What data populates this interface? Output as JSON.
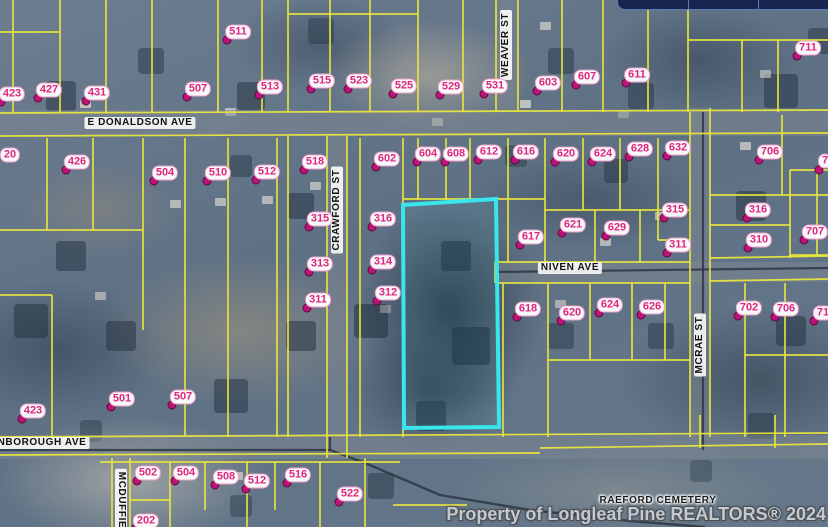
{
  "map": {
    "watermark": "Property of Longleaf Pine REALTORS® 2024",
    "colors": {
      "parcel_line": "#e9e63e",
      "highlight": "#38e6ec",
      "label_text": "#e0267f",
      "marker_dot": "#bb1377",
      "boundary_dark": "#2a3240",
      "road_fill": "rgba(128,136,146,0.5)"
    },
    "highlight_parcel_points": "403,205 496,199 499,427 404,428",
    "parcel_labels": [
      {
        "t": "423",
        "x": 12,
        "y": 94
      },
      {
        "t": "427",
        "x": 49,
        "y": 90
      },
      {
        "t": "431",
        "x": 97,
        "y": 93
      },
      {
        "t": "507",
        "x": 198,
        "y": 89
      },
      {
        "t": "511",
        "x": 238,
        "y": 32
      },
      {
        "t": "513",
        "x": 270,
        "y": 87
      },
      {
        "t": "515",
        "x": 322,
        "y": 81
      },
      {
        "t": "523",
        "x": 359,
        "y": 81
      },
      {
        "t": "525",
        "x": 404,
        "y": 86
      },
      {
        "t": "529",
        "x": 451,
        "y": 87
      },
      {
        "t": "531",
        "x": 495,
        "y": 86
      },
      {
        "t": "603",
        "x": 548,
        "y": 83
      },
      {
        "t": "607",
        "x": 587,
        "y": 77
      },
      {
        "t": "611",
        "x": 637,
        "y": 75
      },
      {
        "t": "711",
        "x": 808,
        "y": 48
      },
      {
        "t": "20",
        "x": 10,
        "y": 155,
        "dot": false
      },
      {
        "t": "426",
        "x": 77,
        "y": 162
      },
      {
        "t": "504",
        "x": 165,
        "y": 173
      },
      {
        "t": "510",
        "x": 218,
        "y": 173
      },
      {
        "t": "512",
        "x": 267,
        "y": 172
      },
      {
        "t": "518",
        "x": 315,
        "y": 162
      },
      {
        "t": "602",
        "x": 387,
        "y": 159
      },
      {
        "t": "604",
        "x": 428,
        "y": 154
      },
      {
        "t": "608",
        "x": 456,
        "y": 154
      },
      {
        "t": "612",
        "x": 489,
        "y": 152
      },
      {
        "t": "616",
        "x": 526,
        "y": 152
      },
      {
        "t": "620",
        "x": 566,
        "y": 154
      },
      {
        "t": "624",
        "x": 603,
        "y": 154
      },
      {
        "t": "628",
        "x": 640,
        "y": 149
      },
      {
        "t": "632",
        "x": 678,
        "y": 148
      },
      {
        "t": "706",
        "x": 770,
        "y": 152
      },
      {
        "t": "7",
        "x": 825,
        "y": 161,
        "ddx": -6,
        "ddy": 9
      },
      {
        "t": "315",
        "x": 320,
        "y": 219
      },
      {
        "t": "316",
        "x": 383,
        "y": 219
      },
      {
        "t": "617",
        "x": 531,
        "y": 237
      },
      {
        "t": "621",
        "x": 573,
        "y": 225
      },
      {
        "t": "629",
        "x": 617,
        "y": 228
      },
      {
        "t": "315",
        "x": 675,
        "y": 210
      },
      {
        "t": "311",
        "x": 678,
        "y": 245
      },
      {
        "t": "316",
        "x": 758,
        "y": 210
      },
      {
        "t": "310",
        "x": 759,
        "y": 240
      },
      {
        "t": "707",
        "x": 815,
        "y": 232
      },
      {
        "t": "313",
        "x": 320,
        "y": 264
      },
      {
        "t": "314",
        "x": 383,
        "y": 262
      },
      {
        "t": "311",
        "x": 318,
        "y": 300
      },
      {
        "t": "312",
        "x": 388,
        "y": 293
      },
      {
        "t": "618",
        "x": 528,
        "y": 309
      },
      {
        "t": "620",
        "x": 572,
        "y": 313
      },
      {
        "t": "624",
        "x": 610,
        "y": 305
      },
      {
        "t": "626",
        "x": 652,
        "y": 307
      },
      {
        "t": "702",
        "x": 749,
        "y": 308
      },
      {
        "t": "706",
        "x": 786,
        "y": 309
      },
      {
        "t": "71",
        "x": 823,
        "y": 313,
        "ddx": -9,
        "ddy": 8
      },
      {
        "t": "423",
        "x": 33,
        "y": 411
      },
      {
        "t": "501",
        "x": 122,
        "y": 399
      },
      {
        "t": "507",
        "x": 183,
        "y": 397
      },
      {
        "t": "502",
        "x": 148,
        "y": 473
      },
      {
        "t": "504",
        "x": 186,
        "y": 473
      },
      {
        "t": "508",
        "x": 226,
        "y": 477
      },
      {
        "t": "512",
        "x": 257,
        "y": 481
      },
      {
        "t": "516",
        "x": 298,
        "y": 475
      },
      {
        "t": "522",
        "x": 350,
        "y": 494
      },
      {
        "t": "202",
        "x": 146,
        "y": 521
      }
    ],
    "street_labels": [
      {
        "t": "E DONALDSON AVE",
        "x": 140,
        "y": 123,
        "rot": "none"
      },
      {
        "t": "WEAVER ST",
        "x": 506,
        "y": 45,
        "rot": "m90"
      },
      {
        "t": "CRAWFORD ST",
        "x": 337,
        "y": 210,
        "rot": "m90"
      },
      {
        "t": "NIVEN AVE",
        "x": 570,
        "y": 268,
        "rot": "none"
      },
      {
        "t": "MCRAE ST",
        "x": 700,
        "y": 345,
        "rot": "m90"
      },
      {
        "t": "NBOROUGH AVE",
        "x": 42,
        "y": 443,
        "rot": "none"
      },
      {
        "t": "MCDUFFIE",
        "x": 121,
        "y": 500,
        "rot": "90"
      },
      {
        "t": "RAEFORD CEMETERY",
        "x": 658,
        "y": 501,
        "rot": "none",
        "halo": true
      }
    ],
    "roads": [
      [
        0,
        110,
        828,
        26
      ],
      [
        496,
        0,
        22,
        112
      ],
      [
        327,
        136,
        20,
        322
      ],
      [
        495,
        262,
        333,
        20
      ],
      [
        690,
        108,
        20,
        332
      ],
      [
        0,
        435,
        828,
        24
      ],
      [
        112,
        458,
        18,
        69
      ]
    ],
    "parcel_lines": [
      [
        13,
        0,
        13,
        112
      ],
      [
        60,
        0,
        60,
        112
      ],
      [
        106,
        0,
        106,
        112
      ],
      [
        152,
        0,
        152,
        112
      ],
      [
        218,
        0,
        218,
        112
      ],
      [
        262,
        0,
        262,
        112
      ],
      [
        288,
        0,
        288,
        112
      ],
      [
        330,
        0,
        330,
        112
      ],
      [
        370,
        0,
        370,
        112
      ],
      [
        418,
        0,
        418,
        112
      ],
      [
        463,
        0,
        463,
        112
      ],
      [
        496,
        0,
        496,
        112
      ],
      [
        518,
        0,
        518,
        112
      ],
      [
        562,
        0,
        562,
        112
      ],
      [
        603,
        0,
        603,
        112
      ],
      [
        648,
        0,
        648,
        112
      ],
      [
        688,
        0,
        688,
        112
      ],
      [
        742,
        40,
        742,
        112
      ],
      [
        778,
        40,
        778,
        112
      ],
      [
        0,
        32,
        60,
        32
      ],
      [
        288,
        14,
        418,
        14
      ],
      [
        688,
        40,
        828,
        40
      ],
      [
        0,
        113,
        828,
        110
      ],
      [
        0,
        136,
        828,
        133
      ],
      [
        47,
        138,
        47,
        230
      ],
      [
        93,
        138,
        93,
        230
      ],
      [
        0,
        230,
        143,
        230
      ],
      [
        143,
        138,
        143,
        330
      ],
      [
        185,
        138,
        185,
        437
      ],
      [
        228,
        138,
        228,
        437
      ],
      [
        277,
        138,
        277,
        437
      ],
      [
        0,
        295,
        52,
        295
      ],
      [
        52,
        295,
        52,
        437
      ],
      [
        288,
        136,
        288,
        437
      ],
      [
        327,
        136,
        327,
        458
      ],
      [
        347,
        136,
        347,
        458
      ],
      [
        360,
        138,
        360,
        437
      ],
      [
        403,
        138,
        403,
        437
      ],
      [
        418,
        138,
        418,
        199
      ],
      [
        446,
        138,
        446,
        199
      ],
      [
        470,
        138,
        470,
        199
      ],
      [
        508,
        138,
        508,
        262
      ],
      [
        545,
        138,
        545,
        262
      ],
      [
        403,
        199,
        545,
        199
      ],
      [
        545,
        210,
        690,
        210
      ],
      [
        583,
        138,
        583,
        210
      ],
      [
        620,
        138,
        620,
        210
      ],
      [
        658,
        138,
        658,
        240
      ],
      [
        658,
        240,
        690,
        240
      ],
      [
        595,
        210,
        595,
        262
      ],
      [
        640,
        210,
        640,
        262
      ],
      [
        495,
        262,
        690,
        262
      ],
      [
        495,
        262,
        495,
        283
      ],
      [
        495,
        283,
        690,
        283
      ],
      [
        710,
        258,
        828,
        256
      ],
      [
        710,
        281,
        828,
        279
      ],
      [
        690,
        112,
        690,
        437
      ],
      [
        710,
        108,
        710,
        437
      ],
      [
        503,
        283,
        503,
        437
      ],
      [
        548,
        283,
        548,
        437
      ],
      [
        590,
        283,
        590,
        360
      ],
      [
        632,
        283,
        632,
        360
      ],
      [
        665,
        283,
        665,
        360
      ],
      [
        548,
        360,
        690,
        360
      ],
      [
        710,
        195,
        828,
        195
      ],
      [
        782,
        115,
        782,
        195
      ],
      [
        710,
        225,
        790,
        225
      ],
      [
        790,
        170,
        790,
        258
      ],
      [
        790,
        170,
        828,
        170
      ],
      [
        817,
        170,
        817,
        255
      ],
      [
        790,
        255,
        828,
        255
      ],
      [
        745,
        283,
        745,
        437
      ],
      [
        785,
        283,
        785,
        437
      ],
      [
        745,
        355,
        828,
        355
      ],
      [
        0,
        437,
        828,
        433
      ],
      [
        0,
        455,
        540,
        453
      ],
      [
        540,
        448,
        828,
        444
      ],
      [
        112,
        458,
        112,
        527
      ],
      [
        130,
        458,
        130,
        527
      ],
      [
        170,
        462,
        170,
        527
      ],
      [
        205,
        462,
        205,
        510
      ],
      [
        247,
        462,
        247,
        527
      ],
      [
        275,
        462,
        275,
        510
      ],
      [
        320,
        462,
        320,
        527
      ],
      [
        365,
        458,
        365,
        527
      ],
      [
        100,
        462,
        400,
        462
      ],
      [
        393,
        505,
        467,
        505
      ],
      [
        130,
        500,
        170,
        500
      ],
      [
        775,
        415,
        775,
        448
      ],
      [
        700,
        415,
        700,
        448
      ]
    ],
    "dark_lines": [
      [
        703,
        112,
        703,
        450
      ],
      [
        495,
        272,
        828,
        268
      ],
      [
        0,
        450,
        330,
        450
      ],
      [
        330,
        437,
        330,
        450
      ]
    ],
    "dark_paths": [
      "330,450 365,463 440,495 530,510 630,521 705,527"
    ]
  },
  "overlay_bar": {
    "segments": 3
  }
}
